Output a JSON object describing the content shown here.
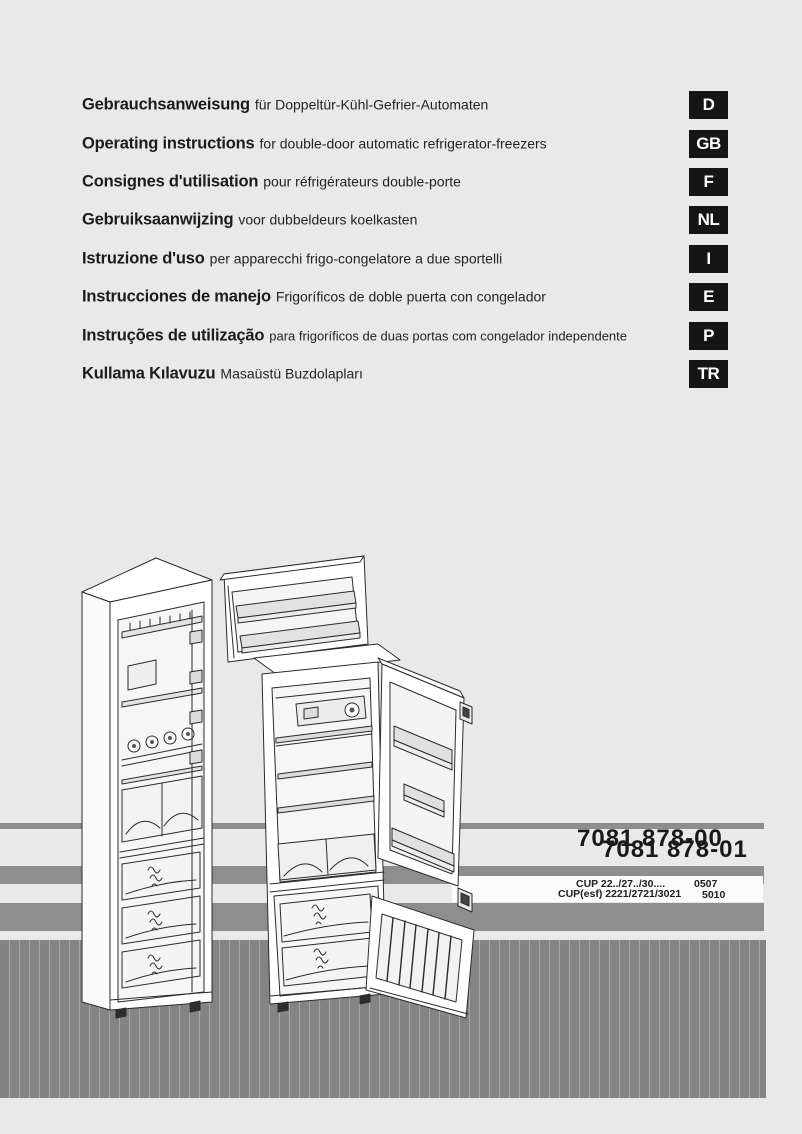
{
  "languages": [
    {
      "title": "Gebrauchsanweisung",
      "desc": "für Doppeltür-Kühl-Gefrier-Automaten",
      "badge": "D"
    },
    {
      "title": "Operating instructions",
      "desc": "for double-door automatic refrigerator-freezers",
      "badge": "GB"
    },
    {
      "title": "Consignes d'utilisation",
      "desc": "pour réfrigérateurs double-porte",
      "badge": "F"
    },
    {
      "title": "Gebruiksaanwijzing",
      "desc": "voor dubbeldeurs koelkasten",
      "badge": "NL"
    },
    {
      "title": "Istruzione d'uso",
      "desc": "per apparecchi frigo-congelatore a due sportelli",
      "badge": "I"
    },
    {
      "title": "Instrucciones de manejo",
      "desc": "Frigoríficos de doble puerta con congelador",
      "badge": "E"
    },
    {
      "title": "Instruções de utilização",
      "desc": "para frigoríficos de duas portas com congelador independente",
      "badge": "P"
    },
    {
      "title": "Kullama Kılavuzu",
      "desc": "Masaüstü Buzdolapları",
      "badge": "TR"
    }
  ],
  "part_numbers": {
    "primary": "7081 878-00",
    "secondary": "7081 878-01"
  },
  "model_codes": {
    "line1_label": "CUP 22../27../30....",
    "line1_code": "0507",
    "line2_label": "CUP(esf) 2221/2721/3021",
    "line2_code": "5010"
  },
  "illustration_alt": "line drawing of double-door refrigerator-freezers with open doors",
  "colors": {
    "page_bg": "#e9e9e9",
    "stripe_gray": "#8e8e8e",
    "striped_band_gray": "#848484",
    "striped_band_line": "#a7a7a7",
    "badge_bg": "#151515",
    "text": "#1d1d1d",
    "code_strip_bg": "#fbfbfb"
  }
}
